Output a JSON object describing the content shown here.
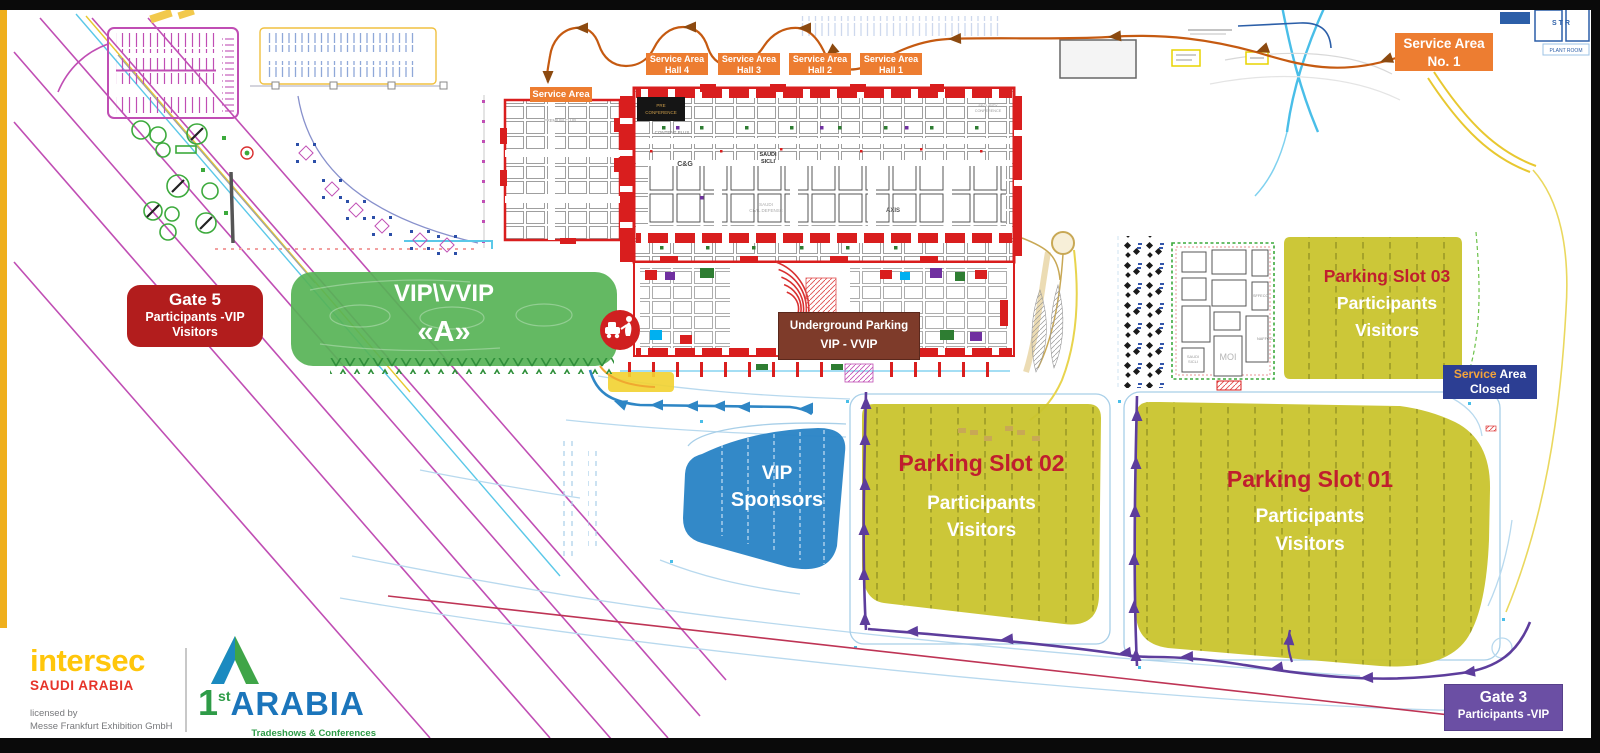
{
  "colors": {
    "label_orange": "#ED7D31",
    "hall_red": "#D91E1E",
    "gate_red": "#B21D1D",
    "underground_brown": "#7E3B2A",
    "vip_green": "#57B356",
    "parking_yellow": "#C9C42D",
    "parking_title_red": "#C01E2E",
    "sponsors_blue": "#2B84C6",
    "closed_navy": "#2C3E93",
    "gate3_purple": "#6B4FA4",
    "route_orange": "#C55A11",
    "route_blue": "#2E86C5",
    "route_purple": "#5D3D9C",
    "road_magenta": "#C04EB4",
    "frame_black": "#0A0A0A",
    "edge_yellow": "#EFAF1C"
  },
  "top": {
    "service_area": "Service Area",
    "halls": [
      {
        "l1": "Service Area",
        "l2": "Hall 4"
      },
      {
        "l1": "Service Area",
        "l2": "Hall 3"
      },
      {
        "l1": "Service Area",
        "l2": "Hall 2"
      },
      {
        "l1": "Service Area",
        "l2": "Hall 1"
      }
    ],
    "no1": {
      "l1": "Service Area",
      "l2": "No. 1"
    }
  },
  "zones": {
    "gate5": {
      "l1": "Gate 5",
      "l2": "Participants -VIP",
      "l3": "Visitors"
    },
    "vip_a": {
      "l1": "VIP\\VVIP",
      "l2": "«A»"
    },
    "underground": {
      "l1": "Underground Parking",
      "l2": "VIP - VVIP"
    },
    "sponsors": {
      "l1": "VIP",
      "l2": "Sponsors"
    },
    "p01": {
      "title": "Parking Slot 01",
      "l2": "Participants",
      "l3": "Visitors"
    },
    "p02": {
      "title": "Parking Slot 02",
      "l2": "Participants",
      "l3": "Visitors"
    },
    "p03": {
      "title": "Parking Slot 03",
      "l2": "Participants",
      "l3": "Visitors"
    },
    "closed": {
      "w1": "Service",
      "w2": " Area",
      "l2": "Closed"
    },
    "gate3": {
      "l1": "Gate 3",
      "l2": "Participants -VIP"
    }
  },
  "map_texts": {
    "pre1": "PRE",
    "pre2": "CONFERENCE",
    "premium": "PREMIUM CLUB",
    "content": "CONTENT PLUS",
    "cg": "C&G",
    "sicli1": "SAUDI",
    "sicli2": "SICLI",
    "civil1": "SAUDI",
    "civil2": "CIVIL DEFENSE",
    "axis": "AXIS",
    "sec1": "SECURITY",
    "sec2": "CONFERENCE",
    "moi": "MOI",
    "out_sicli1": "SAUDI",
    "out_sicli2": "SICLI",
    "naffco": "NAFFCO",
    "sffeco": "SFFECO",
    "str": "S T R",
    "plant": "PLANT ROOM"
  },
  "footer": {
    "intersec": {
      "name": "intersec",
      "country": "SAUDI ARABIA",
      "lic1": "licensed by",
      "lic2": "Messe Frankfurt Exhibition GmbH"
    },
    "arabia": {
      "num": "1",
      "sup": "st",
      "name": "ARABIA",
      "tag": "Tradeshows & Conferences"
    }
  }
}
